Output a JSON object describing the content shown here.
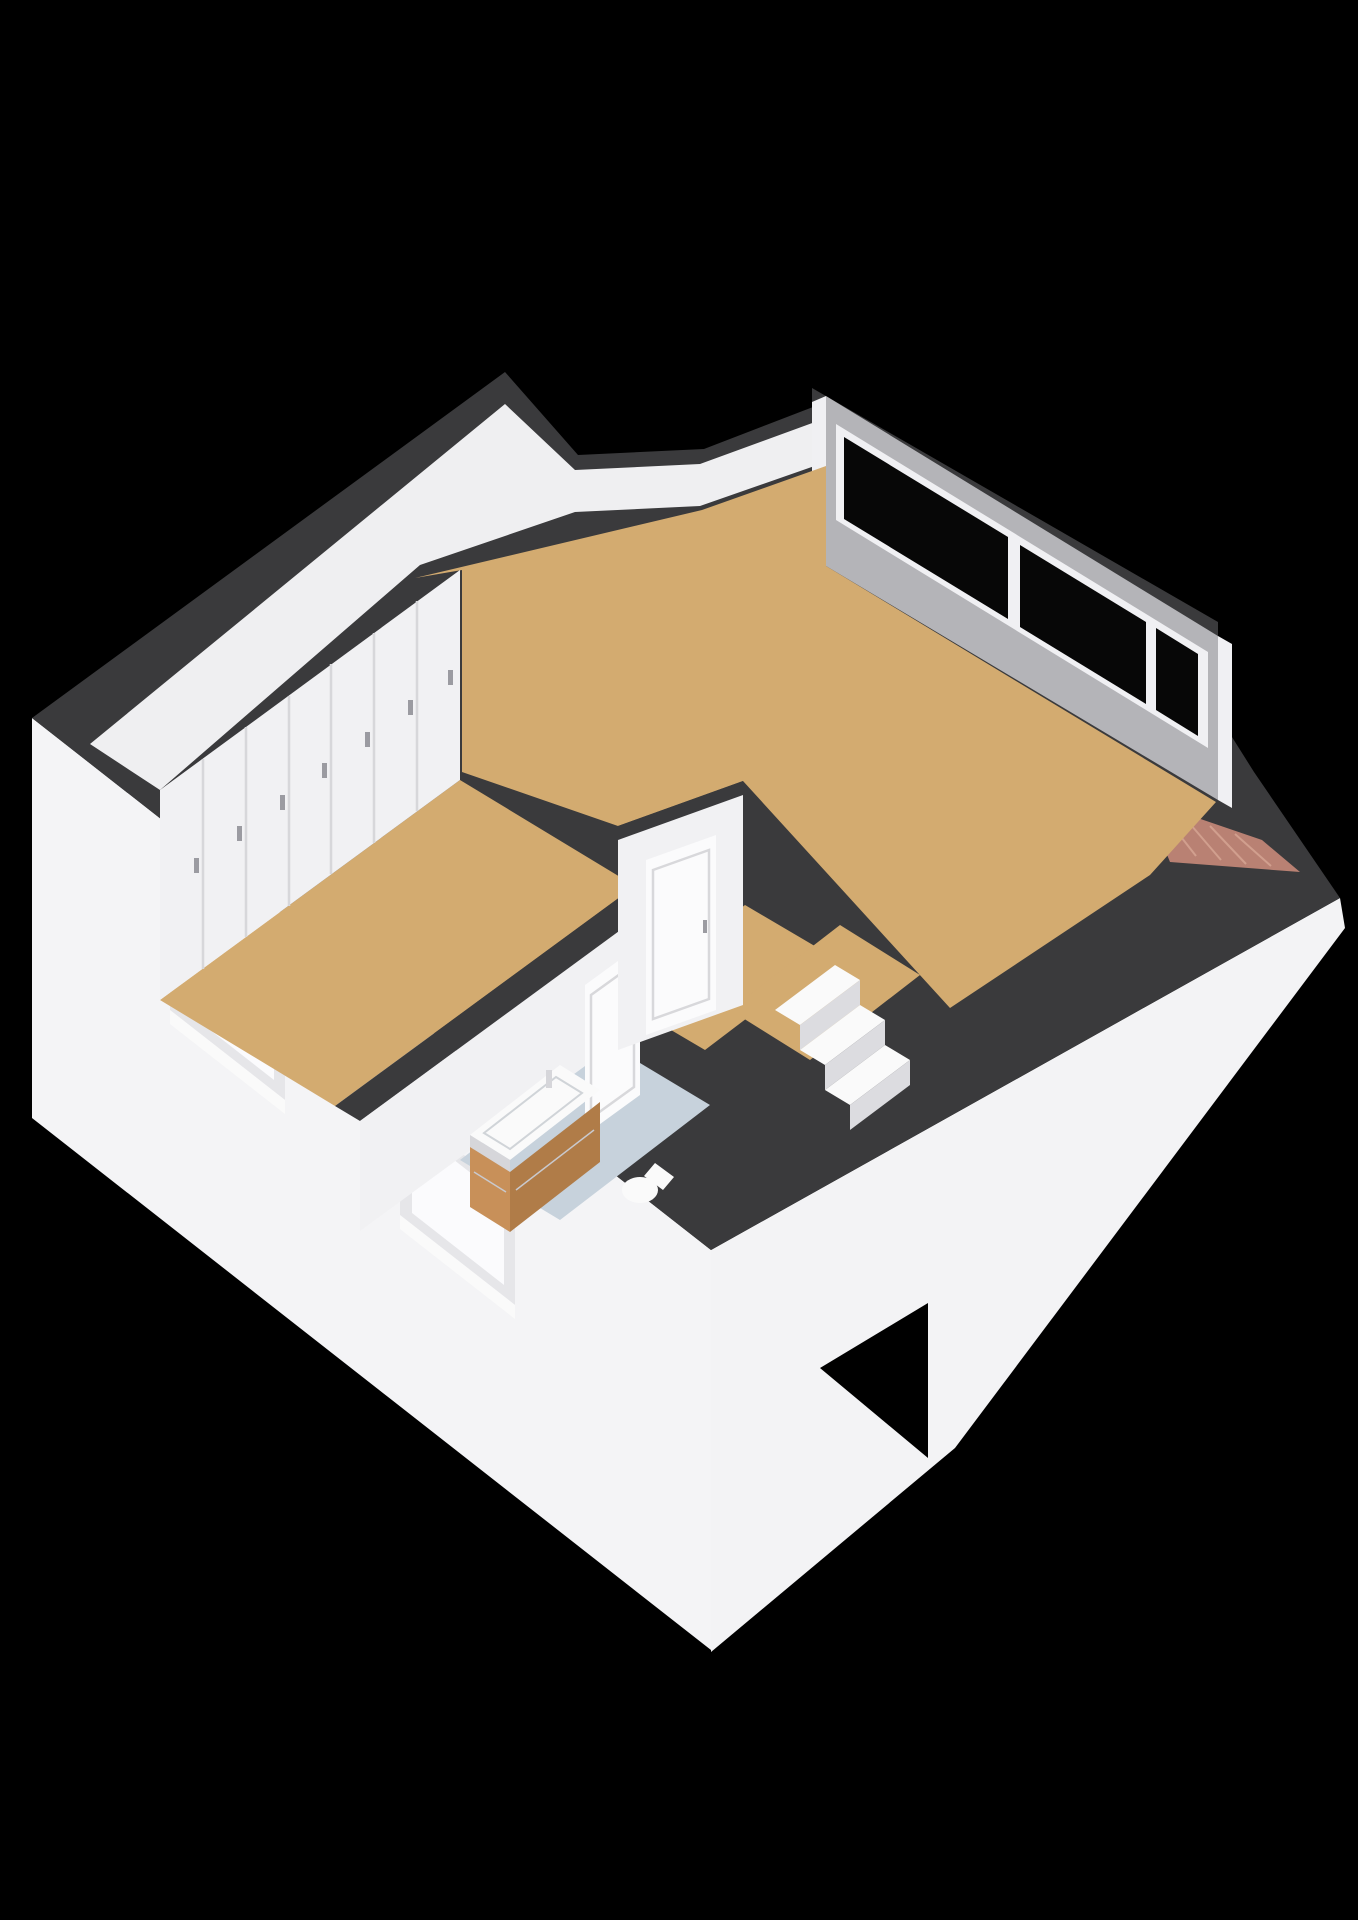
{
  "scene": {
    "description": "3D rendered attic floor plan on black background",
    "background": "#000000",
    "colors": {
      "wall_cut": "#3a3a3c",
      "exterior_face": "#f4f4f6",
      "roof_white": "#f3f3f5",
      "ceiling_white": "#efeff1",
      "interior_face": "#f1f1f3",
      "interior_face_shaded": "#d6d6da",
      "gable_face": "#b4b4b8",
      "window_frame": "#f0f0f3",
      "glass_dark": "#070707",
      "facade_window_frame": "#e6e6e9",
      "facade_window_glass": "#fbfbfd",
      "floor_wood": "#d3ab70",
      "floor_bathroom": "#c7d2dc",
      "roof_brick": "#b98173",
      "cabinet_wood": "#c89059",
      "cabinet_wood_dark": "#b07c48",
      "fixture_white": "#fafafa",
      "door_white": "#fbfbfc",
      "step_front": "#dcdce0"
    },
    "counts": {
      "closet_doors": 7,
      "gable_window_panes": 3,
      "facade_windows": 2,
      "stair_steps": 3,
      "interior_doors": 2
    },
    "rooms": [
      {
        "name": "bedroom",
        "floor": "wood",
        "feature": "closet-wall"
      },
      {
        "name": "living-area",
        "floor": "wood",
        "feature": "gable-window-wall"
      },
      {
        "name": "hallway",
        "floor": "wood",
        "feature": "doors"
      },
      {
        "name": "bathroom",
        "floor": "tile",
        "feature": "vanity-and-toilet"
      },
      {
        "name": "stair-landing",
        "floor": "wood",
        "feature": "staircase"
      }
    ]
  }
}
